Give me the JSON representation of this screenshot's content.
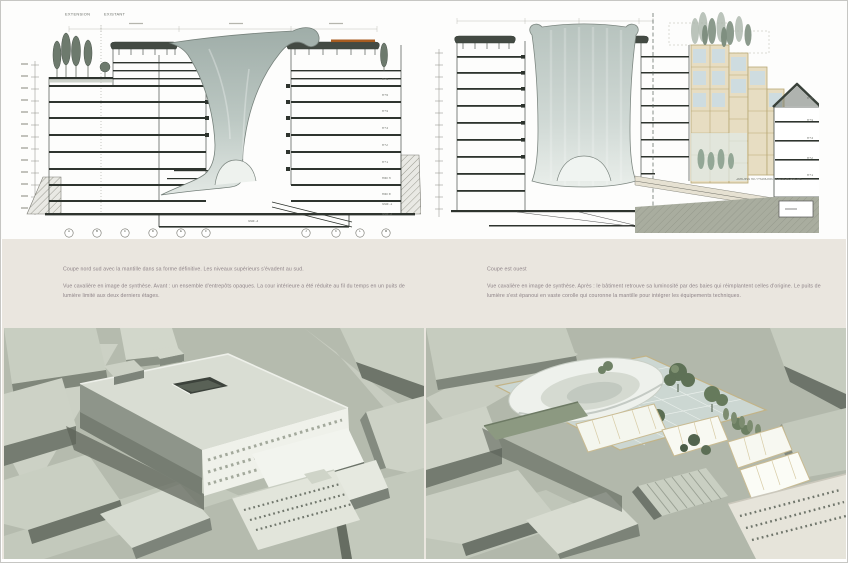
{
  "board": {
    "band_bg": "#eae6df",
    "page_bg": "#ffffff",
    "border_color": "#c6c6c3"
  },
  "sections": {
    "left": {
      "label_extension": "EXTENSION",
      "label_existant": "EXISTANT",
      "grid_labels": [
        "A",
        "B",
        "C",
        "D",
        "E",
        "F",
        "J",
        "K",
        "L",
        "M"
      ],
      "floor_labels": [
        "R+6",
        "R+5",
        "R+4",
        "R+3",
        "R+2",
        "R+1",
        "Rdc h",
        "Rdc b",
        "Ssol -1",
        "Ssol -2"
      ],
      "basement_label": "Ssol -3"
    },
    "right": {
      "floor_labels": [
        "R+5",
        "R+4",
        "R+3",
        "R+2",
        "R+1"
      ],
      "annotation": "JARDINS 90 / PIGNONS 38 RUE BLANCHE"
    }
  },
  "captions": {
    "left_title": "Coupe nord sud avec la mantille dans sa forme définitive. Les niveaux supérieurs s'évadent au sud.",
    "left_body": "Vue cavalière en image de synthèse. Avant : un ensemble d'entrepôts opaques. La cour intérieure a été réduite au fil du temps en un puits de lumière limité aux deux derniers étages.",
    "right_title": "Coupe est ouest",
    "right_body": "Vue cavalière en image de synthèse. Après : le bâtiment retrouve sa luminosité par des baies qui réimplantent celles d'origine. Le puits de lumière s'est épanoui en vaste corolle qui couronne la mantille pour intégrer les équipements techniques."
  },
  "palette": {
    "ink": "#2e342e",
    "mantille_light": "#dde4e0",
    "mantille_dark": "#a6b3ae",
    "accent_orange": "#a85c20",
    "facade_beige": "#e7ddc2",
    "glass_blue": "#ccdce4",
    "tree_green": "#6d7a6d",
    "render_bg": "#b5bbae"
  }
}
